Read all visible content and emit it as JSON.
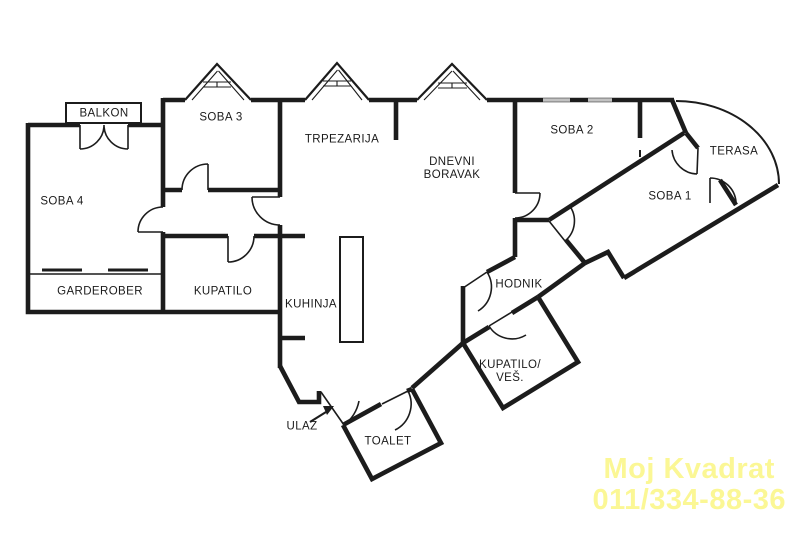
{
  "plan": {
    "type": "apartment-floor-plan",
    "wall_color": "#1c1c1c",
    "window_color": "#c2c2c2",
    "background": "#ffffff"
  },
  "rooms": [
    {
      "id": "balkon",
      "lines": [
        "BALKON"
      ],
      "x": 104,
      "y": 114
    },
    {
      "id": "soba-3",
      "lines": [
        "SOBA 3"
      ],
      "x": 221,
      "y": 118
    },
    {
      "id": "soba-4",
      "lines": [
        "SOBA 4"
      ],
      "x": 62,
      "y": 202
    },
    {
      "id": "garderober",
      "lines": [
        "GARDEROBER"
      ],
      "x": 100,
      "y": 292
    },
    {
      "id": "kupatilo",
      "lines": [
        "KUPATILO"
      ],
      "x": 223,
      "y": 292
    },
    {
      "id": "trpezarija",
      "lines": [
        "TRPEZARIJA"
      ],
      "x": 342,
      "y": 140
    },
    {
      "id": "kuhinja",
      "lines": [
        "KUHINJA"
      ],
      "x": 311,
      "y": 305
    },
    {
      "id": "dnevni-boravak",
      "lines": [
        "DNEVNI",
        "BORAVAK"
      ],
      "x": 452,
      "y": 169
    },
    {
      "id": "soba-2",
      "lines": [
        "SOBA 2"
      ],
      "x": 572,
      "y": 131
    },
    {
      "id": "terasa",
      "lines": [
        "TERASA"
      ],
      "x": 734,
      "y": 152
    },
    {
      "id": "soba-1",
      "lines": [
        "SOBA 1"
      ],
      "x": 670,
      "y": 197
    },
    {
      "id": "hodnik",
      "lines": [
        "HODNIK"
      ],
      "x": 519,
      "y": 285
    },
    {
      "id": "kupatilo-ves",
      "lines": [
        "KUPATILO/",
        "VEŠ."
      ],
      "x": 510,
      "y": 372
    },
    {
      "id": "ulaz",
      "lines": [
        "ULAZ"
      ],
      "x": 302,
      "y": 427
    },
    {
      "id": "toalet",
      "lines": [
        "TOALET"
      ],
      "x": 388,
      "y": 442
    }
  ],
  "icons": {
    "entrance_arrow": "arrow-up-right"
  },
  "watermark": {
    "line1": "Moj Kvadrat",
    "line2": "011/334-88-36",
    "color": "#fbf795"
  }
}
